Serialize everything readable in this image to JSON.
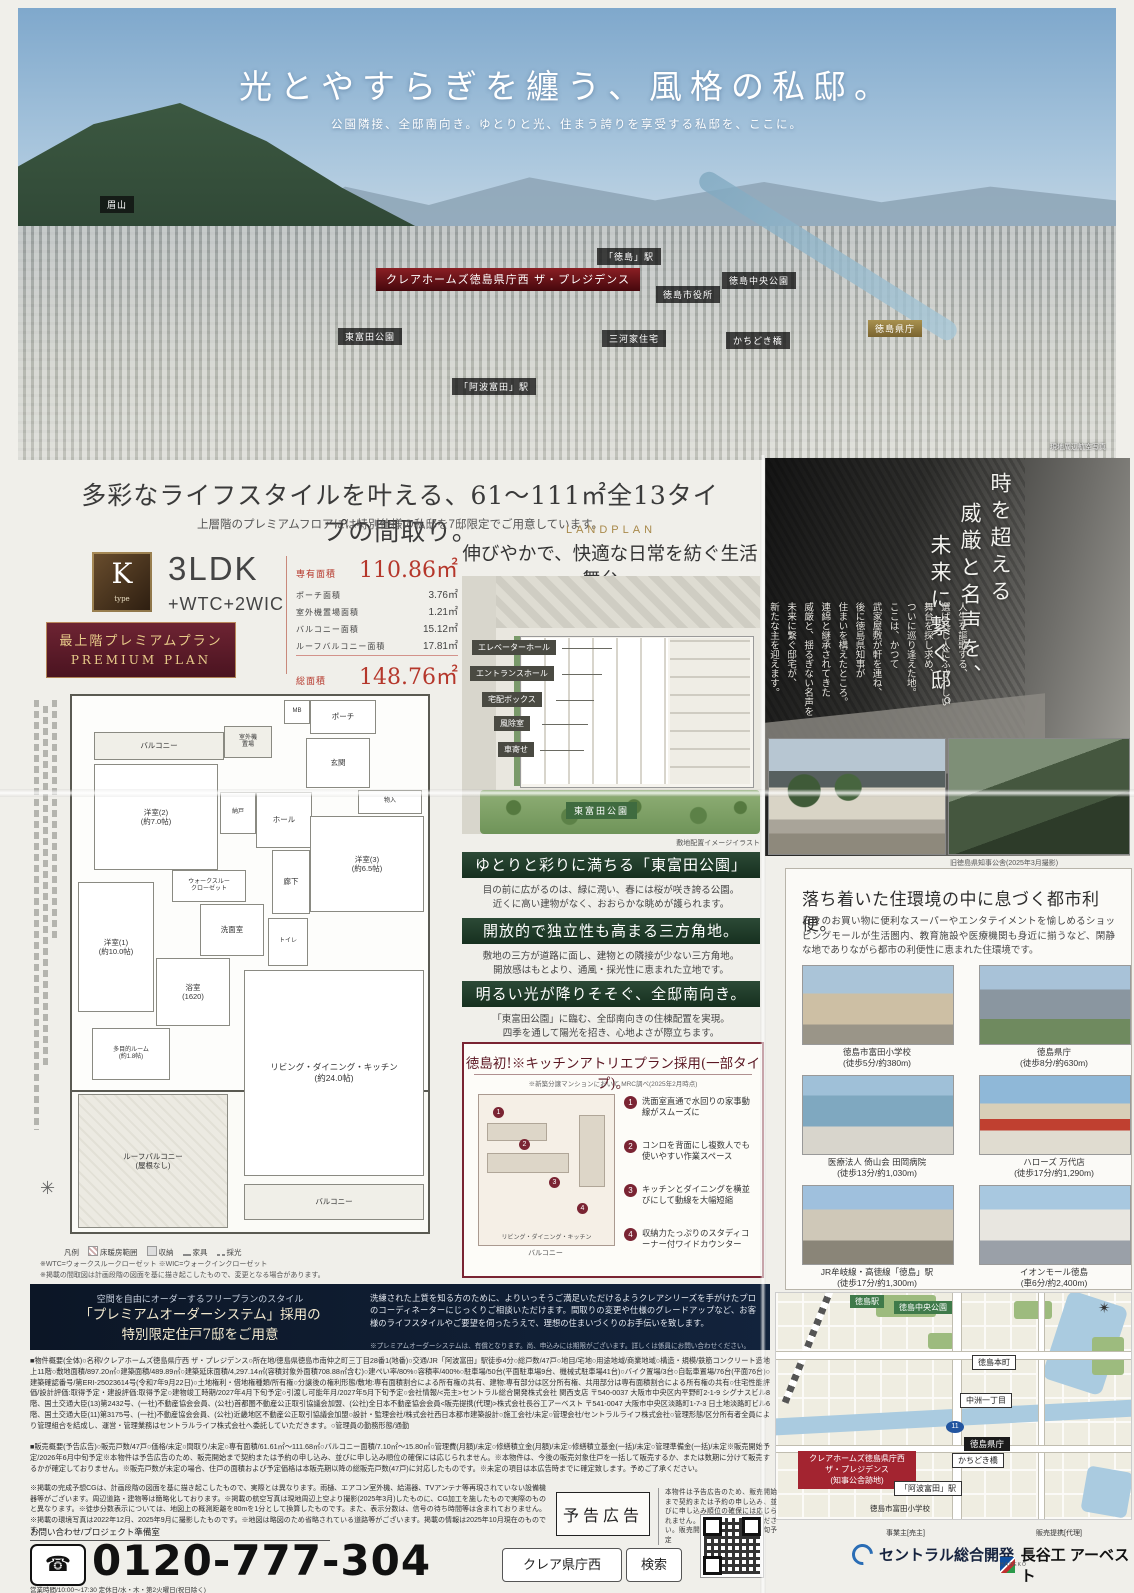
{
  "colors": {
    "accent_red": "#b5372b",
    "maroon": "#7a2433",
    "green": "#23402d",
    "navy": "#101f35",
    "gold": "#a8894a"
  },
  "hero": {
    "title": "光とやすらぎを纏う、風格の私邸。",
    "subtitle": "公園隣接、全邸南向き。ゆとりと光、住まう誇りを享受する私邸を、ここに。",
    "project_label": "クレアホームズ徳島県庁西\nザ・プレジデンス",
    "caption": "現地周辺航空写真",
    "labels": [
      "眉山",
      "「徳島」駅",
      "徳島中央公園",
      "徳島市役所",
      "徳島県庁",
      "かちどき橋",
      "東富田公園",
      "三河家住宅",
      "「阿波富田」駅"
    ]
  },
  "intro": {
    "headline": "多彩なライフスタイルを叶える、61〜111㎡全13タイプの間取り。",
    "sub": "上層階のプレミアムフロアには特別仕様の私邸を7邸限定でご用意しています。"
  },
  "ktype": {
    "badge": "K",
    "badge_sub": "type",
    "layout": "3LDK",
    "layout_sub": "+WTC+2WIC",
    "specs": [
      {
        "label": "専有面積",
        "value": "110.86㎡"
      },
      {
        "label": "ポーチ面積",
        "value": "3.76㎡"
      },
      {
        "label": "室外機置場面積",
        "value": "1.21㎡"
      },
      {
        "label": "バルコニー面積",
        "value": "15.12㎡"
      },
      {
        "label": "ルーフバルコニー面積",
        "value": "17.81㎡"
      },
      {
        "label": "総面積",
        "value": "148.76㎡"
      }
    ],
    "premium1": "最上階プレミアムプラン",
    "premium2": "PREMIUM PLAN",
    "rooms": [
      "ポーチ",
      "MB",
      "バルコニー",
      "室外機\n置場",
      "洋室(2)\n(約7.0帖)",
      "玄関",
      "ホール",
      "洋室(3)\n(約6.5帖)",
      "廊下",
      "納戸",
      "物入",
      "ウォークスルー\nクローゼット",
      "洗面室",
      "トイレ",
      "浴室\n(1620)",
      "洋室(1)\n(約10.0帖)",
      "多目的ルーム\n(約1.8帖)",
      "リビング・ダイニング・キッチン\n(約24.0帖)",
      "ルーフバルコニー\n(屋根なし)",
      "バルコニー"
    ],
    "legend": [
      "凡例",
      "床暖房範囲",
      "収納",
      "家具",
      "採光"
    ],
    "notes": "※WTC=ウォークスルークローゼット ※WIC=ウォークインクローゼット\n※掲載の間取図は計画段階の図面を基に描き起こしたもので、変更となる場合があります。"
  },
  "landplan": {
    "tag": "LANDPLAN",
    "headline": "伸びやかで、快適な日常を紡ぐ生活舞台。",
    "labels": [
      "エレベーターホール",
      "エントランスホール",
      "宅配ボックス",
      "風除室",
      "車寄せ"
    ],
    "park": "東富田公園",
    "caption": "敷地配置イメージイラスト"
  },
  "features": [
    {
      "title": "ゆとりと彩りに満ちる「東富田公園」前。",
      "body": "目の前に広がるのは、緑に潤い、春には桜が咲き誇る公園。\n近くに高い建物がなく、おおらかな眺めが護られます。"
    },
    {
      "title": "開放的で独立性も高まる三方角地。",
      "body": "敷地の三方が道路に面し、建物との隣接が少ない三方角地。\n開放感はもとより、通風・採光性に恵まれた立地です。"
    },
    {
      "title": "明るい光が降りそそぐ、全邸南向き。",
      "body": "「東富田公園」に臨む、全邸南向きの住棟配置を実現。\n四季を通して陽光を招き、心地よさが際立ちます。"
    }
  ],
  "kitchen": {
    "title": "徳島初!※キッチンアトリエプラン採用(一部タイプ)。",
    "note": "※新築分譲マンションにおいて MRC調べ(2025年2月時点)",
    "plan_label": "リビング・ダイニング・キッチン",
    "balcony_label": "バルコニー",
    "items": [
      {
        "num": "1",
        "text": "洗面室直通で水回りの家事動線がスムーズに"
      },
      {
        "num": "2",
        "text": "コンロを背面にし複数人でも使いやすい作業スペース"
      },
      {
        "num": "3",
        "text": "キッチンとダイニングを横並びにして動線を大幅短縮"
      },
      {
        "num": "4",
        "text": "収納力たっぷりのスタディコーナー付ワイドカウンター"
      }
    ]
  },
  "heritage": {
    "line1": "時を超える",
    "line2": "威厳と名声を、",
    "line3": "未来に繋ぐ邸。",
    "body": "人生を謳歌する、\n選ばれし人にふさわしい\n舞台を探し求め、\nついに巡り逢えた地。\nここは、かつて\n武家屋敷が軒を連ね、\n後に徳島県知事が\n住まいを構えたところ。\n連綿と継承されてきた\n威厳と、揺るぎない名声を\n未来に繋ぐ邸宅が、\n新たな主を迎えます。",
    "caption": "旧徳島県知事公舎(2025年3月撮影)"
  },
  "urban": {
    "headline": "落ち着いた住環境の中に息づく都市利便。",
    "body": "日々のお買い物に便利なスーパーやエンタテイメントを愉しめるショッピングモールが生活圏内、教育施設や医療機関も身近に揃うなど、閑静な地でありながら都市の利便性に恵まれた住環境です。",
    "facilities": [
      {
        "name": "徳島市富田小学校",
        "access": "(徒歩5分/約380m)"
      },
      {
        "name": "徳島県庁",
        "access": "(徒歩8分/約630m)"
      },
      {
        "name": "医療法人 倚山会 田岡病院",
        "access": "(徒歩13分/約1,030m)"
      },
      {
        "name": "ハローズ 万代店",
        "access": "(徒歩17分/約1,290m)"
      },
      {
        "name": "JR牟岐線・高徳線「徳島」駅",
        "access": "(徒歩17分/約1,300m)"
      },
      {
        "name": "イオンモール徳島",
        "access": "(車6分/約2,400m)"
      }
    ]
  },
  "premium_order": {
    "lead": "空間を自由にオーダーするフリープランのスタイル",
    "title": "「プレミアムオーダーシステム」採用の\n特別限定住戸7邸をご用意",
    "body": "洗練された上質を知る方のために、よりいっそうご満足いただけるようクレアシリーズを手がけたプロのコーディネーターにじっくりご相談いただけます。間取りの変更や仕様のグレードアップなど、お客様のライフスタイルやご要望を伺ったうえで、理想の住まいづくりのお手伝いを致します。",
    "note": "※プレミアムオーダーシステムは、有償となります。尚、申込みには期限がございます。詳しくは係員にお問い合わせください。"
  },
  "outline": {
    "a": "■物件概要(全体)○名称/クレアホームズ徳島県庁西 ザ・プレジデンス○所在地/徳島県徳島市南仲之町三丁目28番1(地番)○交通/JR「阿波富田」駅徒歩4分○総戸数/47戸○地目/宅地○用途地域/商業地域○構造・規模/鉄筋コンクリート造地上11階○敷地面積/897.20㎡○建築面積/489.89㎡○建築延床面積/4,297.14㎡(容積対象外面積708.88㎡含む)○建ぺい率/80%○容積率/400%○駐車場/50台(平面駐車場9台、機械式駐車場41台)○バイク置場/3台○自転車置場/76台(平面76台)○建築確認番号/第ERI-25023614号(令和7年9月22日)○土地権利・借地権種類/所有権○分譲後の権利形態/敷地:専有面積割合による所有権の共有、建物:専有部分は区分所有権、共用部分は専有面積割合による所有権の共有○住宅性能評価/設計評価:取得予定・建設評価:取得予定○建物竣工時期/2027年4月下旬予定○引渡し可能年月/2027年5月下旬予定○会社情報/<売主>セントラル総合開発株式会社 関西支店 〒540-0037 大阪市中央区内平野町2-1-9 シグナスビル8階、国土交通大臣(13)第2432号、(一社)不動産協会会員、(公社)首都圏不動産公正取引協議会加盟、(公社)全日本不動産協会会員<販売提携(代理)>株式会社長谷工アーベスト 〒541-0047 大阪市中央区淡路町1-7-3 日土地淡路町ビル6階、国土交通大臣(11)第3175号、(一社)不動産協会会員、(公社)近畿地区不動産公正取引協議会加盟○設計・監理会社/株式会社西日本都市建築設計○施工会社/未定○管理会社/セントラルライフ株式会社○管理形態/区分所有者全員により管理組合を結成し、運営・管理業務はセントラルライフ株式会社へ委託していただきます。○管理員の勤務形態/通勤",
    "b": "■販売概要(予告広告)○販売戸数/47戸○価格/未定○間取り/未定○専有面積/61.61㎡〜111.68㎡○バルコニー面積/7.10㎡〜15.80㎡○管理費(月額)/未定○修繕積立金(月額)/未定○修繕積立基金(一括)/未定○管理準備金(一括)/未定※販売開始予定/2026年6月中旬予定※本物件は予告広告のため、販売開始まで契約または予約の申し込み、並びに申し込み順位の確保には応じられません。※本物件は、今後の販売対象住戸を一括して販売するか、または数期に分けて販売するかが確定しておりません。※販売戸数が未定の場合、住戸の面積および予定価格は本販売期以降の総販売戸数(47戸)に対応したものです。※未定の項目は本広告時までに確定致します。予めご了承ください。",
    "c": "※掲載の完成予想CGは、計画段階の図面を基に描き起こしたもので、実際とは異なります。雨樋、エアコン室外機、給湯器、TVアンテナ等再現されていない設備機器等がございます。周辺道路・建物等は簡略化しております。※掲載の航空写真は現地周辺上空より撮影(2025年3月)したものに、CG加工を施したもので実際のものと異なります。※徒歩分数表示については、地図上の概測距離を80mを1分として換算したものです。また、表示分数は、信号の待ち時間等は含まれておりません。※掲載の環境写真は2022年12月、2025年9月に撮影したものです。※地図は略図のため省略されている道路等がございます。掲載の情報は2025年10月現在のものです。"
  },
  "notice": {
    "box": "予告広告",
    "text": "本物件は予告広告のため、販売開始まで契約または予約の申し込み、並びに申し込み順位の確保には応じられません。あらかじめご了承ください。販売開始予定/2026年6月中旬予定"
  },
  "contact": {
    "label": "お問い合わせ/プロジェクト準備室",
    "phone": "0120-777-304",
    "search_word": "クレア県庁西",
    "search_btn": "検索",
    "hours": "営業時間/10:00〜17:30 定休日/水・木・第2火曜日(祝日除く)",
    "owner_label": "事業主[売主]",
    "owner": "セントラル総合開発",
    "sales_label": "販売提携[代理]",
    "sales": "長谷工 アーベスト",
    "sales_sub": "HASEKO"
  },
  "map": {
    "station": "徳島駅",
    "park_central": "徳島中央公園",
    "honcho": "徳島本町",
    "nakasu": "中洲一丁目",
    "kencho": "徳島県庁",
    "bridge": "かちどき橋",
    "awatomita": "「阿波富田」駅",
    "school": "徳島市富田小学校",
    "project": "クレアホームズ徳島県庁西\nザ・プレジデンス\n(知事公舎跡地)",
    "route": "11"
  }
}
